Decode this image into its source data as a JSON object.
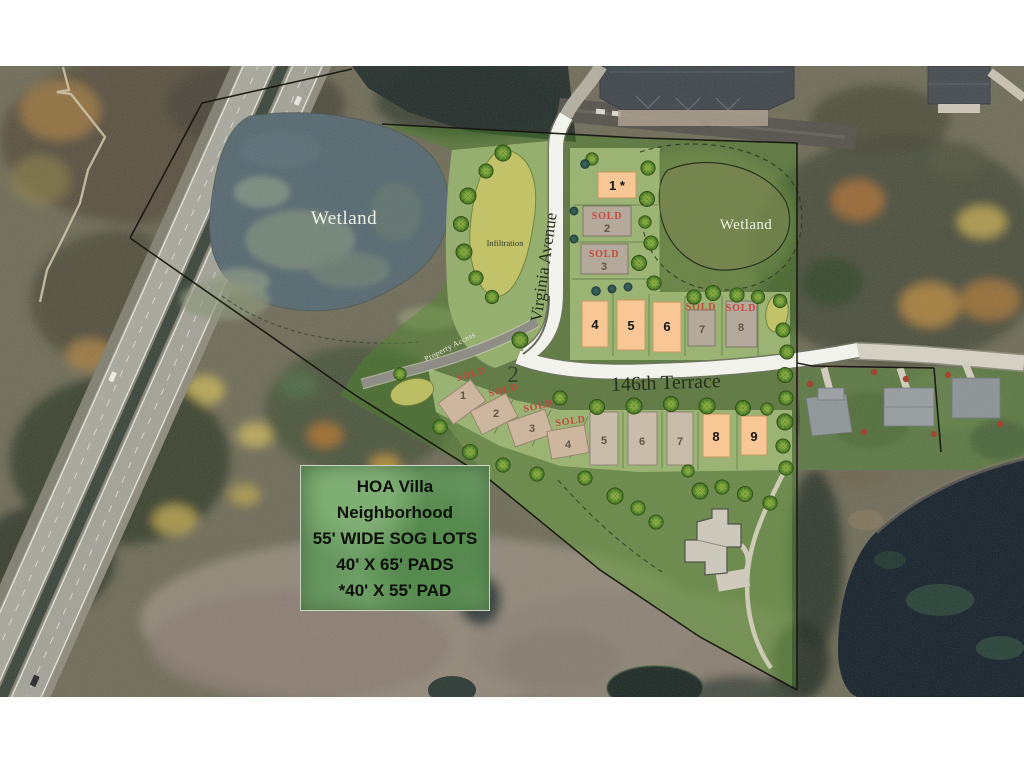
{
  "map": {
    "labels": {
      "wetland_pond": "Wetland",
      "wetland_east": "Wetland",
      "infiltration": "Infiltration",
      "virginia_avenue": "Virginia Avenue",
      "terrace_146th": "146th Terrace",
      "property_access": "Property Access"
    },
    "info_box": {
      "lines": [
        "HOA Villa",
        "Neighborhood",
        "55' WIDE SOG LOTS",
        "40' X 65' PADS",
        "*40' X 55' PAD"
      ]
    },
    "blocks": [
      {
        "number": "1",
        "lots": [
          {
            "number": "1 *",
            "status": "featured"
          },
          {
            "number": "2",
            "status": "sold",
            "sold_label": "SOLD"
          },
          {
            "number": "3",
            "status": "sold",
            "sold_label": "SOLD"
          },
          {
            "number": "4",
            "status": "featured"
          },
          {
            "number": "5",
            "status": "featured"
          },
          {
            "number": "6",
            "status": "featured"
          },
          {
            "number": "7",
            "status": "sold",
            "sold_label": "SOLD"
          },
          {
            "number": "8",
            "status": "sold",
            "sold_label": "SOLD"
          }
        ]
      },
      {
        "number": "2",
        "lots": [
          {
            "number": "1",
            "status": "sold",
            "sold_label": "SOLD"
          },
          {
            "number": "2",
            "status": "sold",
            "sold_label": "SOLD"
          },
          {
            "number": "3",
            "status": "sold",
            "sold_label": "SOLD"
          },
          {
            "number": "4",
            "status": "sold",
            "sold_label": "SOLD"
          },
          {
            "number": "5",
            "status": "available"
          },
          {
            "number": "6",
            "status": "available"
          },
          {
            "number": "7",
            "status": "available"
          },
          {
            "number": "8",
            "status": "featured"
          },
          {
            "number": "9",
            "status": "featured"
          }
        ]
      }
    ],
    "colors": {
      "lot_featured_orange": "#f9c795",
      "lot_sold_gray": "#b4a99b",
      "sold_text_red": "#c8463e",
      "overlay_green": "#4c8c29",
      "plat_road_white": "#f3f3ee",
      "pond_water": "#566870",
      "lake_water": "#15212a",
      "infiltration_basin": "#c6c468",
      "boundary_black": "#15150e"
    }
  }
}
